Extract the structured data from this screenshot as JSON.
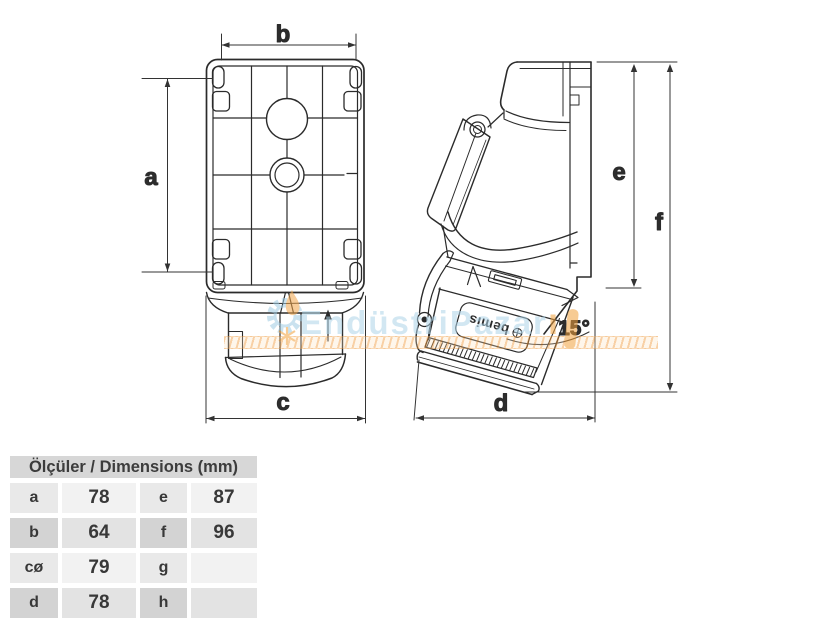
{
  "table": {
    "title": "Ölçüler / Dimensions (mm)",
    "rows": [
      {
        "l1": "a",
        "v1": "78",
        "l2": "e",
        "v2": "87"
      },
      {
        "l1": "b",
        "v1": "64",
        "l2": "f",
        "v2": "96"
      },
      {
        "l1": "cø",
        "v1": "79",
        "l2": "g",
        "v2": ""
      },
      {
        "l1": "d",
        "v1": "78",
        "l2": "h",
        "v2": ""
      }
    ]
  },
  "drawing": {
    "front_view": {
      "dim_width_top": "b",
      "dim_height_left": "a",
      "dim_width_bottom": "c"
    },
    "side_view": {
      "dim_height_inner": "e",
      "dim_height_outer": "f",
      "dim_depth_bottom": "d",
      "angle_label": "15°",
      "brand_label": "bemis"
    }
  },
  "watermark": {
    "text_main": "EndüstriPazar",
    "text_accent": "ı"
  },
  "colors": {
    "line": "#2b2b2b",
    "dimension_line": "#333333",
    "table_header_bg": "#d7d7d7",
    "table_row_light_bg": "#f2f2f2",
    "table_row_dark_bg": "#d3d3d3",
    "watermark_blue": "#aed4e9",
    "watermark_orange": "#f2a13c"
  }
}
